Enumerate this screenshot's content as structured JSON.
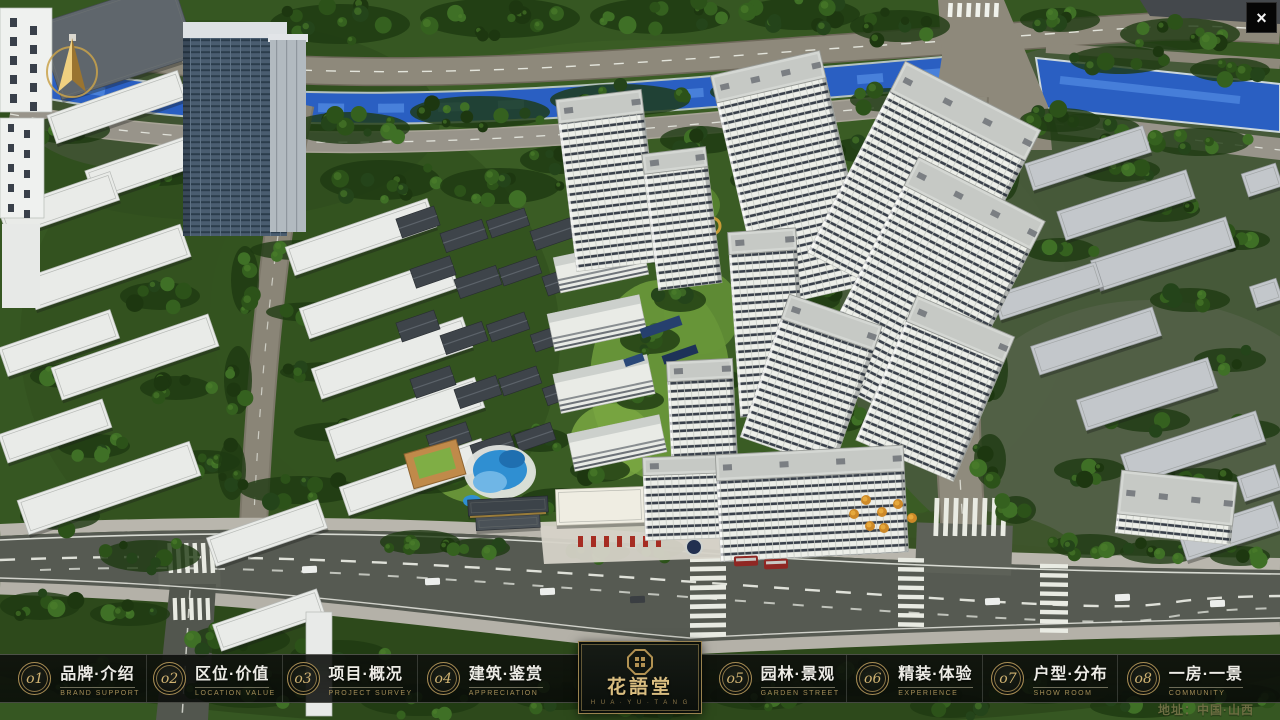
{
  "window": {
    "close_label": "×"
  },
  "nav": {
    "items": [
      {
        "num": "o1",
        "zh": "品牌·介绍",
        "en": "BRAND SUPPORT"
      },
      {
        "num": "o2",
        "zh": "区位·价值",
        "en": "LOCATION VALUE"
      },
      {
        "num": "o3",
        "zh": "项目·概况",
        "en": "PROJECT SURVEY"
      },
      {
        "num": "o4",
        "zh": "建筑·鉴赏",
        "en": "APPRECIATION"
      },
      {
        "num": "o5",
        "zh": "园林·景观",
        "en": "GARDEN STREET"
      },
      {
        "num": "o6",
        "zh": "精装·体验",
        "en": "EXPERIENCE"
      },
      {
        "num": "o7",
        "zh": "户型·分布",
        "en": "SHOW ROOM"
      },
      {
        "num": "o8",
        "zh": "一房·一景",
        "en": "COMMUNITY"
      }
    ]
  },
  "logo": {
    "title": "花語堂",
    "tagline": "H U A · Y U · T A N G"
  },
  "footer": {
    "address": "地址：中国·山西"
  },
  "colors": {
    "accent_gold": "#c9ad6d",
    "nav_bg": "#0b0d0a",
    "river_blue": "#2a5fc2"
  }
}
